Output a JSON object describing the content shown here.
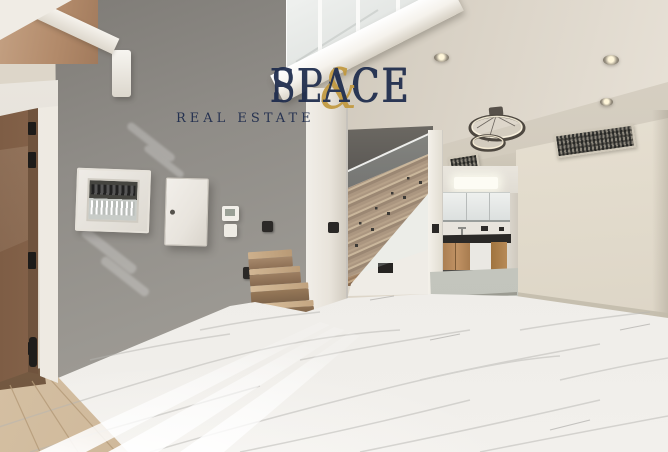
{
  "watermark": {
    "brand": {
      "first": "SPACE",
      "ampersand": "&",
      "second": "PLACE"
    },
    "tagline": "REAL ESTATE",
    "colors": {
      "navy": "#1d2b4c",
      "gold": "#c2993f"
    }
  },
  "scene": {
    "type": "interior-real-estate-photo",
    "areas": [
      "entry-door",
      "gray-accent-wall",
      "staircase-with-glass-balustrade",
      "kitchen",
      "living-area",
      "mezzanine"
    ],
    "fixtures": {
      "ring-pendant-rings": 2,
      "recessed-downlights": 3,
      "ac-vents": 2,
      "electrical-panels": 2,
      "wall-switches": 4
    },
    "colors": {
      "gray_wall": "#97948f",
      "dark_stair_wall": "#615e59",
      "wood_door": "#ab8568",
      "stair_marble": "#a5886a",
      "floor_marble": "#edebe7",
      "warm_wall": "#e3dccd",
      "kitchen_counter": "#2b2927",
      "cabinet_wood": "#b08355"
    }
  }
}
